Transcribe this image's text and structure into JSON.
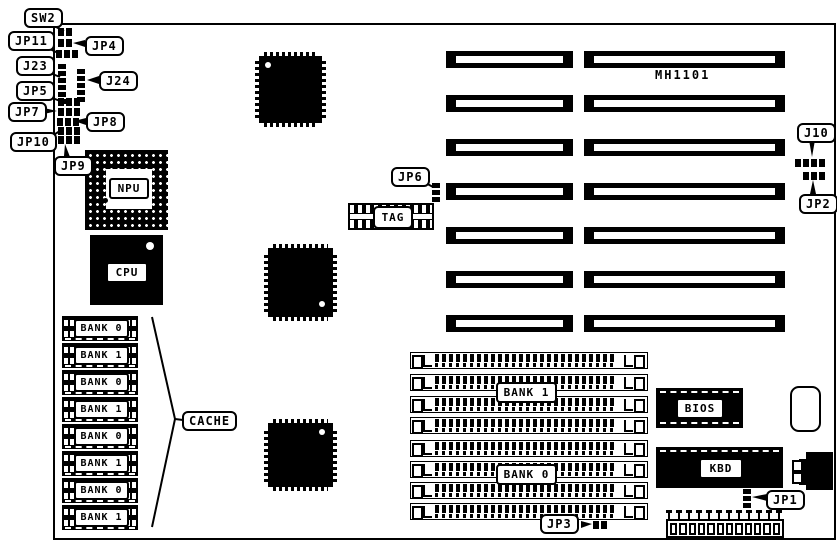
{
  "colors": {
    "ink": "#000000",
    "paper": "#ffffff"
  },
  "board": {
    "model_text": "MH1101"
  },
  "callouts": {
    "sw2": "SW2",
    "jp11": "JP11",
    "jp4": "JP4",
    "j23": "J23",
    "j24": "J24",
    "jp5": "JP5",
    "jp7": "JP7",
    "jp8": "JP8",
    "jp10": "JP10",
    "jp9": "JP9",
    "jp6": "JP6",
    "j10": "J10",
    "jp2": "JP2",
    "jp3": "JP3",
    "jp1": "JP1",
    "cache": "CACHE"
  },
  "chips": {
    "npu": "NPU",
    "cpu": "CPU",
    "tag": "TAG",
    "bios": "BIOS",
    "kbd": "KBD"
  },
  "cache_chips": [
    {
      "label": "BANK 0"
    },
    {
      "label": "BANK 1"
    },
    {
      "label": "BANK 0"
    },
    {
      "label": "BANK 1"
    },
    {
      "label": "BANK 0"
    },
    {
      "label": "BANK 1"
    },
    {
      "label": "BANK 0"
    },
    {
      "label": "BANK 1"
    }
  ],
  "simm_banks": {
    "top": "BANK 1",
    "bottom": "BANK 0"
  }
}
